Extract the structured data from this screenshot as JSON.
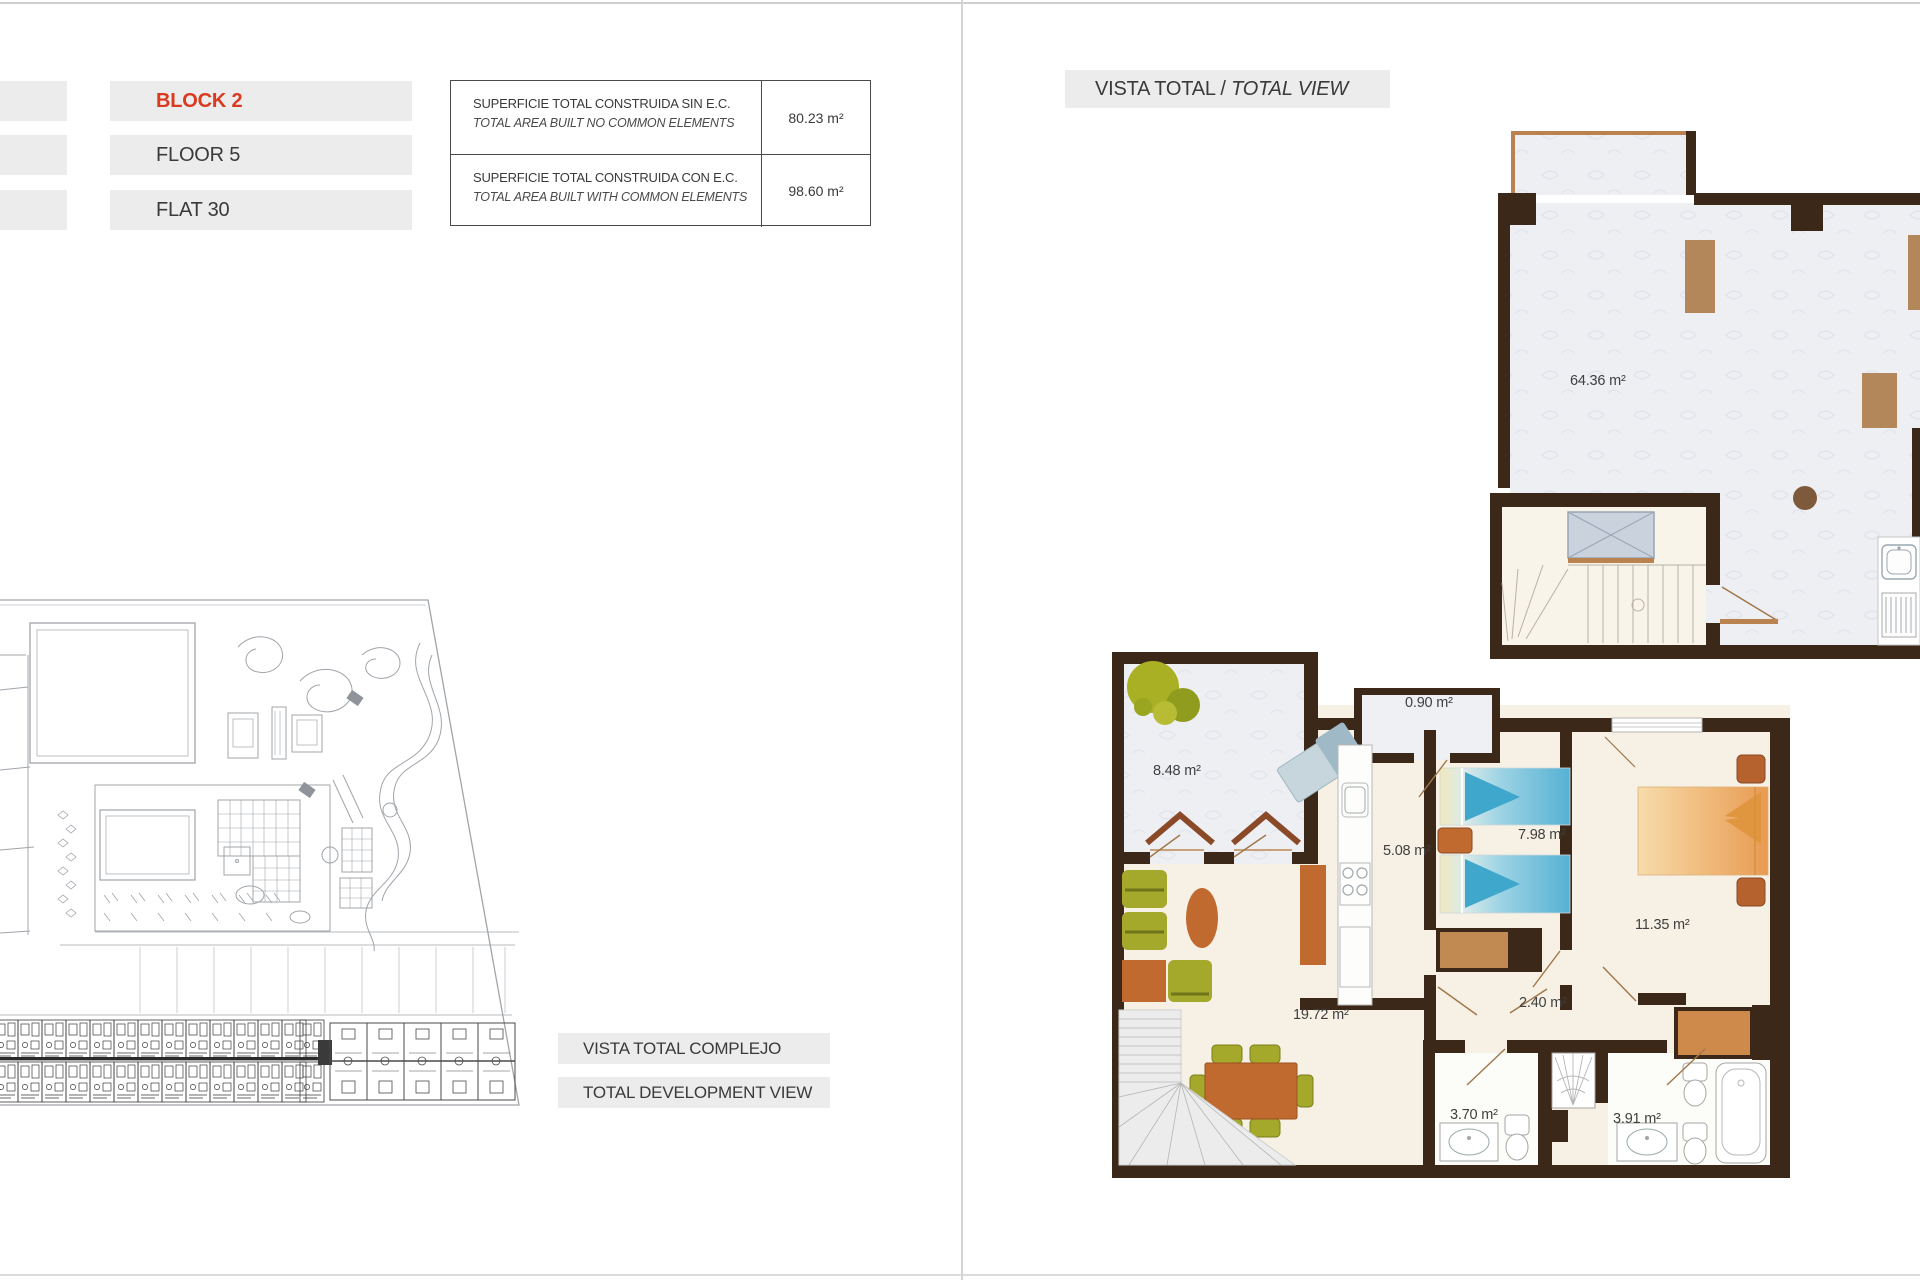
{
  "unit_info": {
    "block": "BLOCK 2",
    "floor": "FLOOR 5",
    "flat": "FLAT 30",
    "accent_color": "#d93a20"
  },
  "area_table": {
    "rows": [
      {
        "title_es": "SUPERFICIE TOTAL CONSTRUIDA SIN E.C.",
        "title_en": "TOTAL AREA BUILT NO COMMON ELEMENTS",
        "value": "80.23 m²"
      },
      {
        "title_es": "SUPERFICIE TOTAL CONSTRUIDA CON E.C.",
        "title_en": "TOTAL AREA BUILT WITH COMMON ELEMENTS",
        "value": "98.60 m²"
      }
    ]
  },
  "site_plan": {
    "label_es": "VISTA TOTAL COMPLEJO",
    "label_en": "TOTAL DEVELOPMENT VIEW"
  },
  "total_view": {
    "label_es": "VISTA TOTAL /",
    "label_en": "TOTAL VIEW",
    "rooms": {
      "solarium": "64.36 m²",
      "terrace": "8.48 m²",
      "closet": "0.90 m²",
      "kitchen": "5.08 m²",
      "bedroom1": "7.98 m²",
      "bedroom2": "11.35 m²",
      "living": "19.72 m²",
      "hall": "2.40 m²",
      "bath1": "3.70 m²",
      "bath2": "3.91 m²"
    }
  },
  "colors": {
    "wall": "#3b2819",
    "tan": "#b9824f",
    "orange_furniture": "#c06a30",
    "olive_furniture": "#a4a82b",
    "bed_blue": "#55b1d4",
    "bed_orange": "#e89a52",
    "floor_cream": "#f6f1e4",
    "floor_roof": "#edeff3",
    "label_box": "#ececec"
  }
}
